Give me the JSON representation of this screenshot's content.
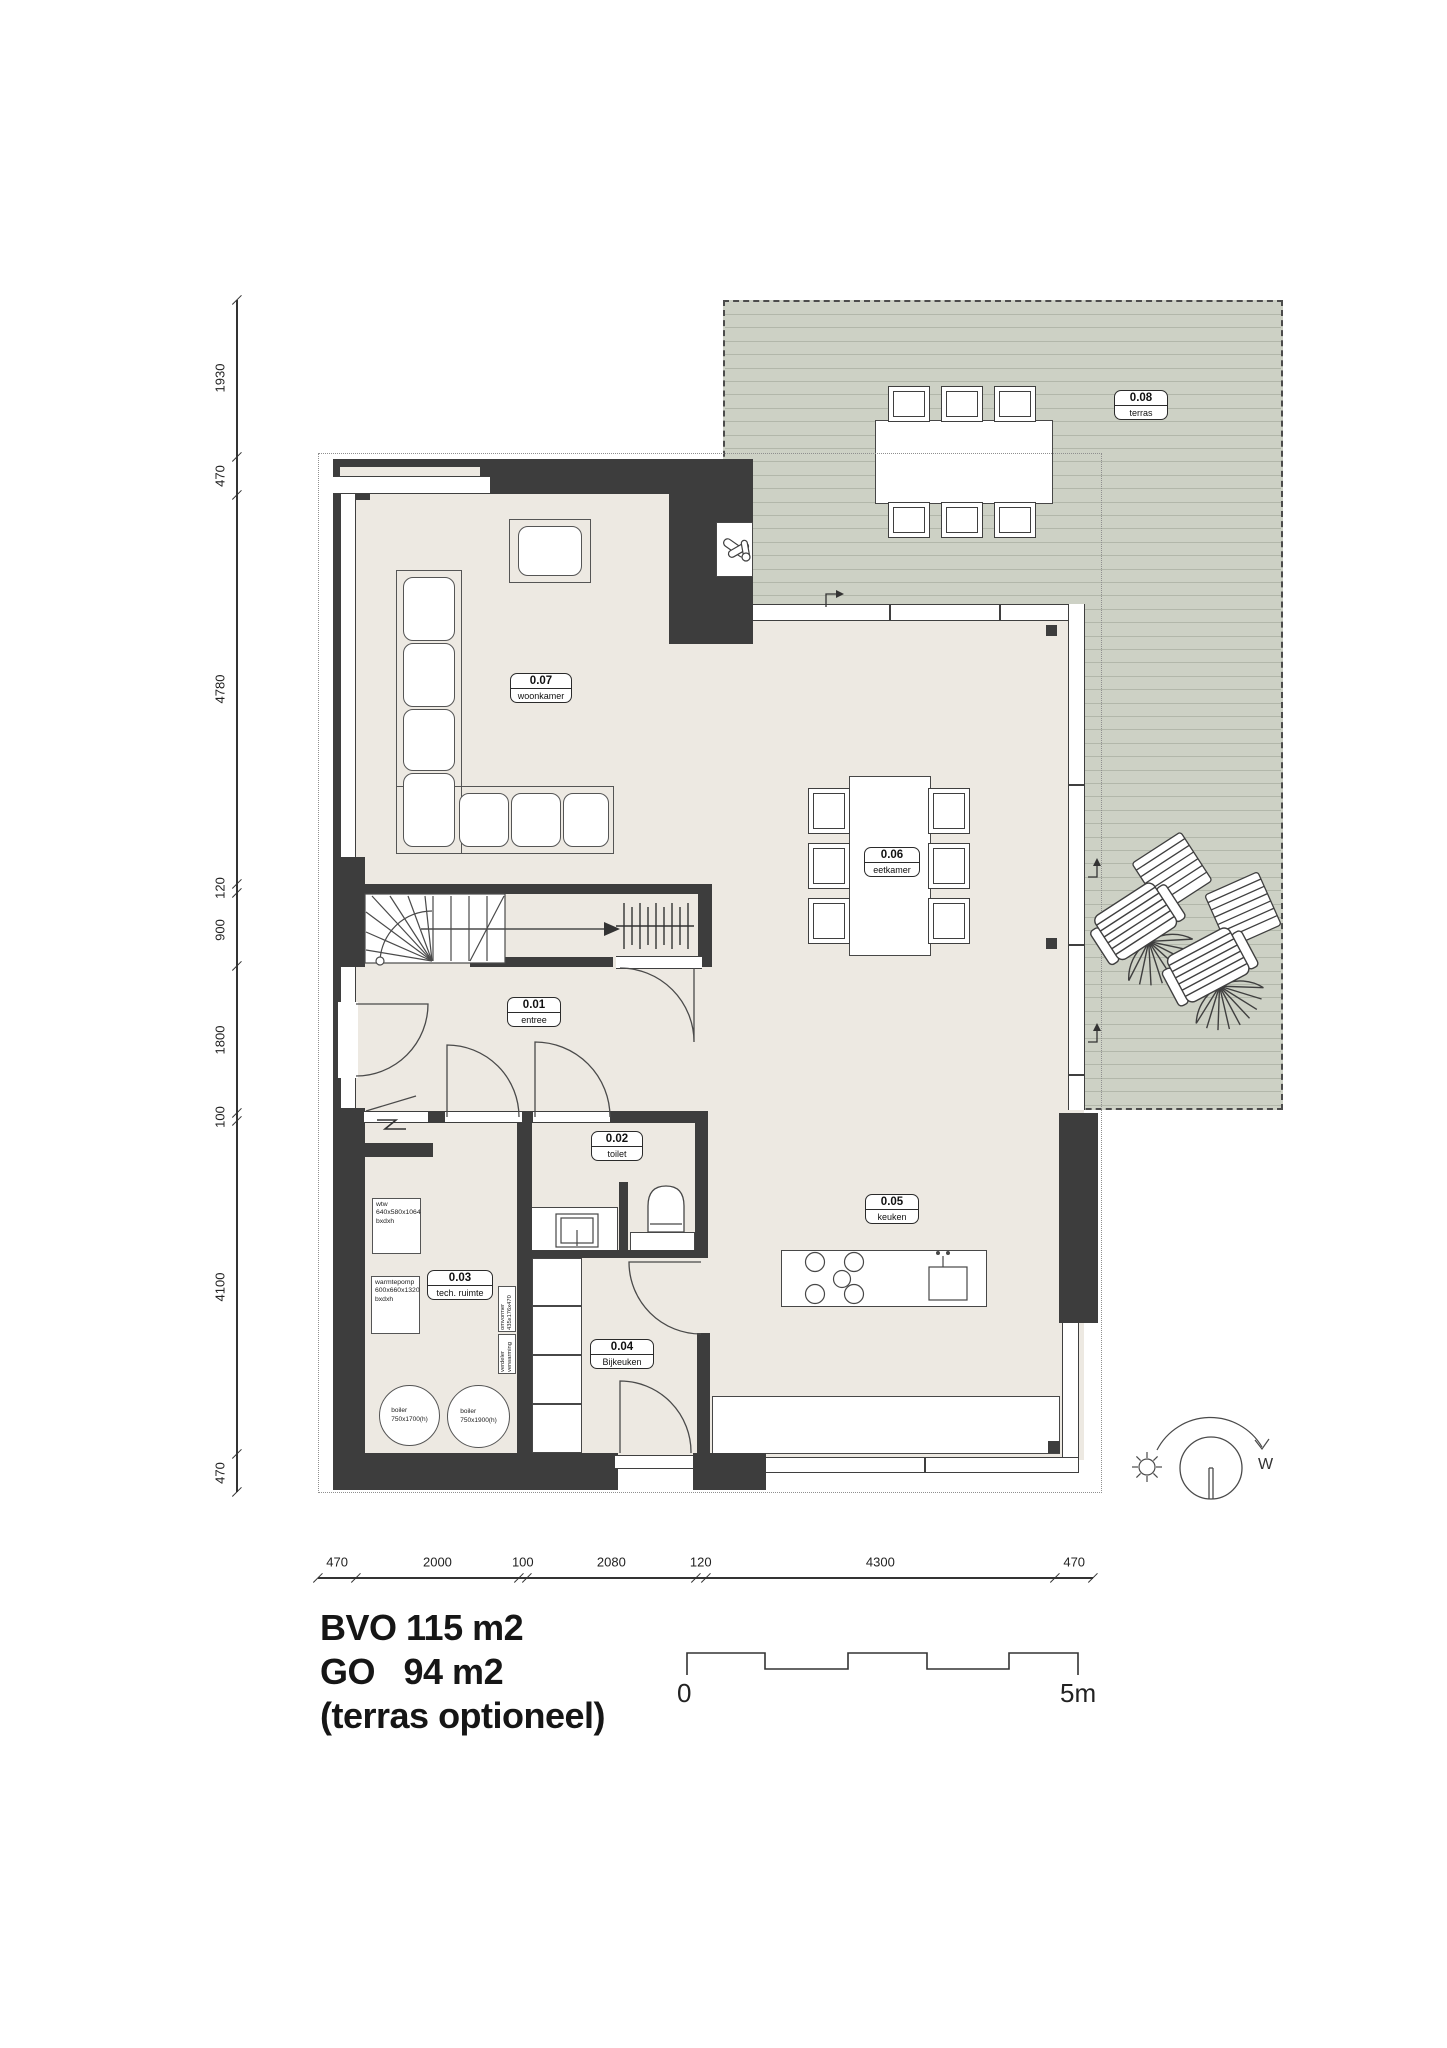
{
  "title_block": {
    "line1": "BVO 115 m2",
    "line2": "GO   94 m2",
    "line3": "(terras optioneel)"
  },
  "scale_bar": {
    "start_label": "0",
    "end_label": "5m"
  },
  "rooms": {
    "r01": {
      "number": "0.01",
      "name": "entree"
    },
    "r02": {
      "number": "0.02",
      "name": "toilet"
    },
    "r03": {
      "number": "0.03",
      "name": "tech. ruimte"
    },
    "r04": {
      "number": "0.04",
      "name": "Bijkeuken"
    },
    "r05": {
      "number": "0.05",
      "name": "keuken"
    },
    "r06": {
      "number": "0.06",
      "name": "eetkamer"
    },
    "r07": {
      "number": "0.07",
      "name": "woonkamer"
    },
    "r08": {
      "number": "0.08",
      "name": "terras"
    }
  },
  "equipment": {
    "wtw": "wtw\n640x580x1064\nbxdxh",
    "warmtepomp": "warmtepomp\n600x660x1320\nbxdxh",
    "omvormer": "omvormer\n435x176x470",
    "verdeler": "verdeler\nverwarming",
    "boiler_left": "boiler\n750x1700(h)",
    "boiler_right": "boiler\n750x1900(h)"
  },
  "dimensions": {
    "left_chain": [
      "1930",
      "470",
      "4780",
      "120",
      "900",
      "1800",
      "100",
      "4100",
      "470"
    ],
    "bottom_chain": [
      "470",
      "2000",
      "100",
      "2080",
      "120",
      "4300",
      "470"
    ]
  },
  "compass": {
    "west_label": "W"
  },
  "colors": {
    "wall": "#3d3d3d",
    "floor": "#ede9e2",
    "terrace": "#cdd1c5",
    "deck_line": "#b2b7aa",
    "line": "#4a4a4a"
  }
}
